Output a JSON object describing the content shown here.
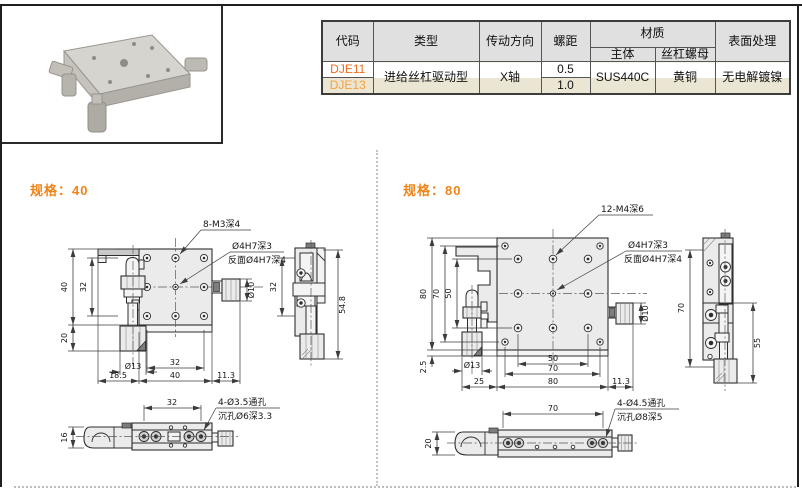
{
  "titles": {
    "spec40": "规格：40",
    "spec80": "规格：80"
  },
  "table": {
    "headers": {
      "code": "代码",
      "type": "类型",
      "direction": "传动方向",
      "pitch": "螺距",
      "material": "材质",
      "body": "主体",
      "nut": "丝杠螺母",
      "surface": "表面处理"
    },
    "row1": {
      "code": "DJE11",
      "pitch": "0.5"
    },
    "row2": {
      "code": "DJE13",
      "pitch": "1.0"
    },
    "shared": {
      "type": "进给丝杠驱动型",
      "direction": "X轴",
      "body": "SUS440C",
      "nut": "黄铜",
      "surface": "无电解镀镍"
    }
  },
  "colors": {
    "accent_orange": "#f08418",
    "code_dje11": "#f26b1d",
    "code_dje13": "#f8a13e",
    "header_bg": "#e0e0e0",
    "row_beige": "#eae6d3"
  },
  "spec40": {
    "callouts": {
      "holes": "8-M3深4",
      "center_front": "Ø4H7深3",
      "center_back": "反面Ø4H7深4",
      "base_holes": "4-Ø3.5通孔",
      "base_counterbore": "沉孔Ø6深3.3"
    },
    "dims": {
      "plate_height": "40",
      "hole_span_v": "32",
      "knob_drop": "20",
      "knob_dia": "Ø13",
      "offset_left": "18.5",
      "hole_span_h": "32",
      "plate_width": "40",
      "knob_overhang": "11.3",
      "shaft_dia": "Ø10",
      "side_hole_span": "32",
      "side_total_height": "54.8",
      "base_hole_span": "32",
      "base_height": "16"
    }
  },
  "spec80": {
    "callouts": {
      "holes": "12-M4深6",
      "center_front": "Ø4H7深3",
      "center_back": "反面Ø4H7深4",
      "base_holes": "4-Ø4.5通孔",
      "base_counterbore": "沉孔Ø8深5"
    },
    "dims": {
      "plate_height": "80",
      "corner_span_v": "70",
      "hole_span_v": "50",
      "base_gap": "2.5",
      "knob_dia": "Ø13",
      "offset_left": "25",
      "hole_span_h": "50",
      "corner_span_h": "70",
      "plate_width": "80",
      "knob_overhang": "11.3",
      "shaft_dia": "Ø10",
      "side_span": "70",
      "side_height": "55",
      "base_hole_span": "70",
      "base_height": "20"
    }
  }
}
